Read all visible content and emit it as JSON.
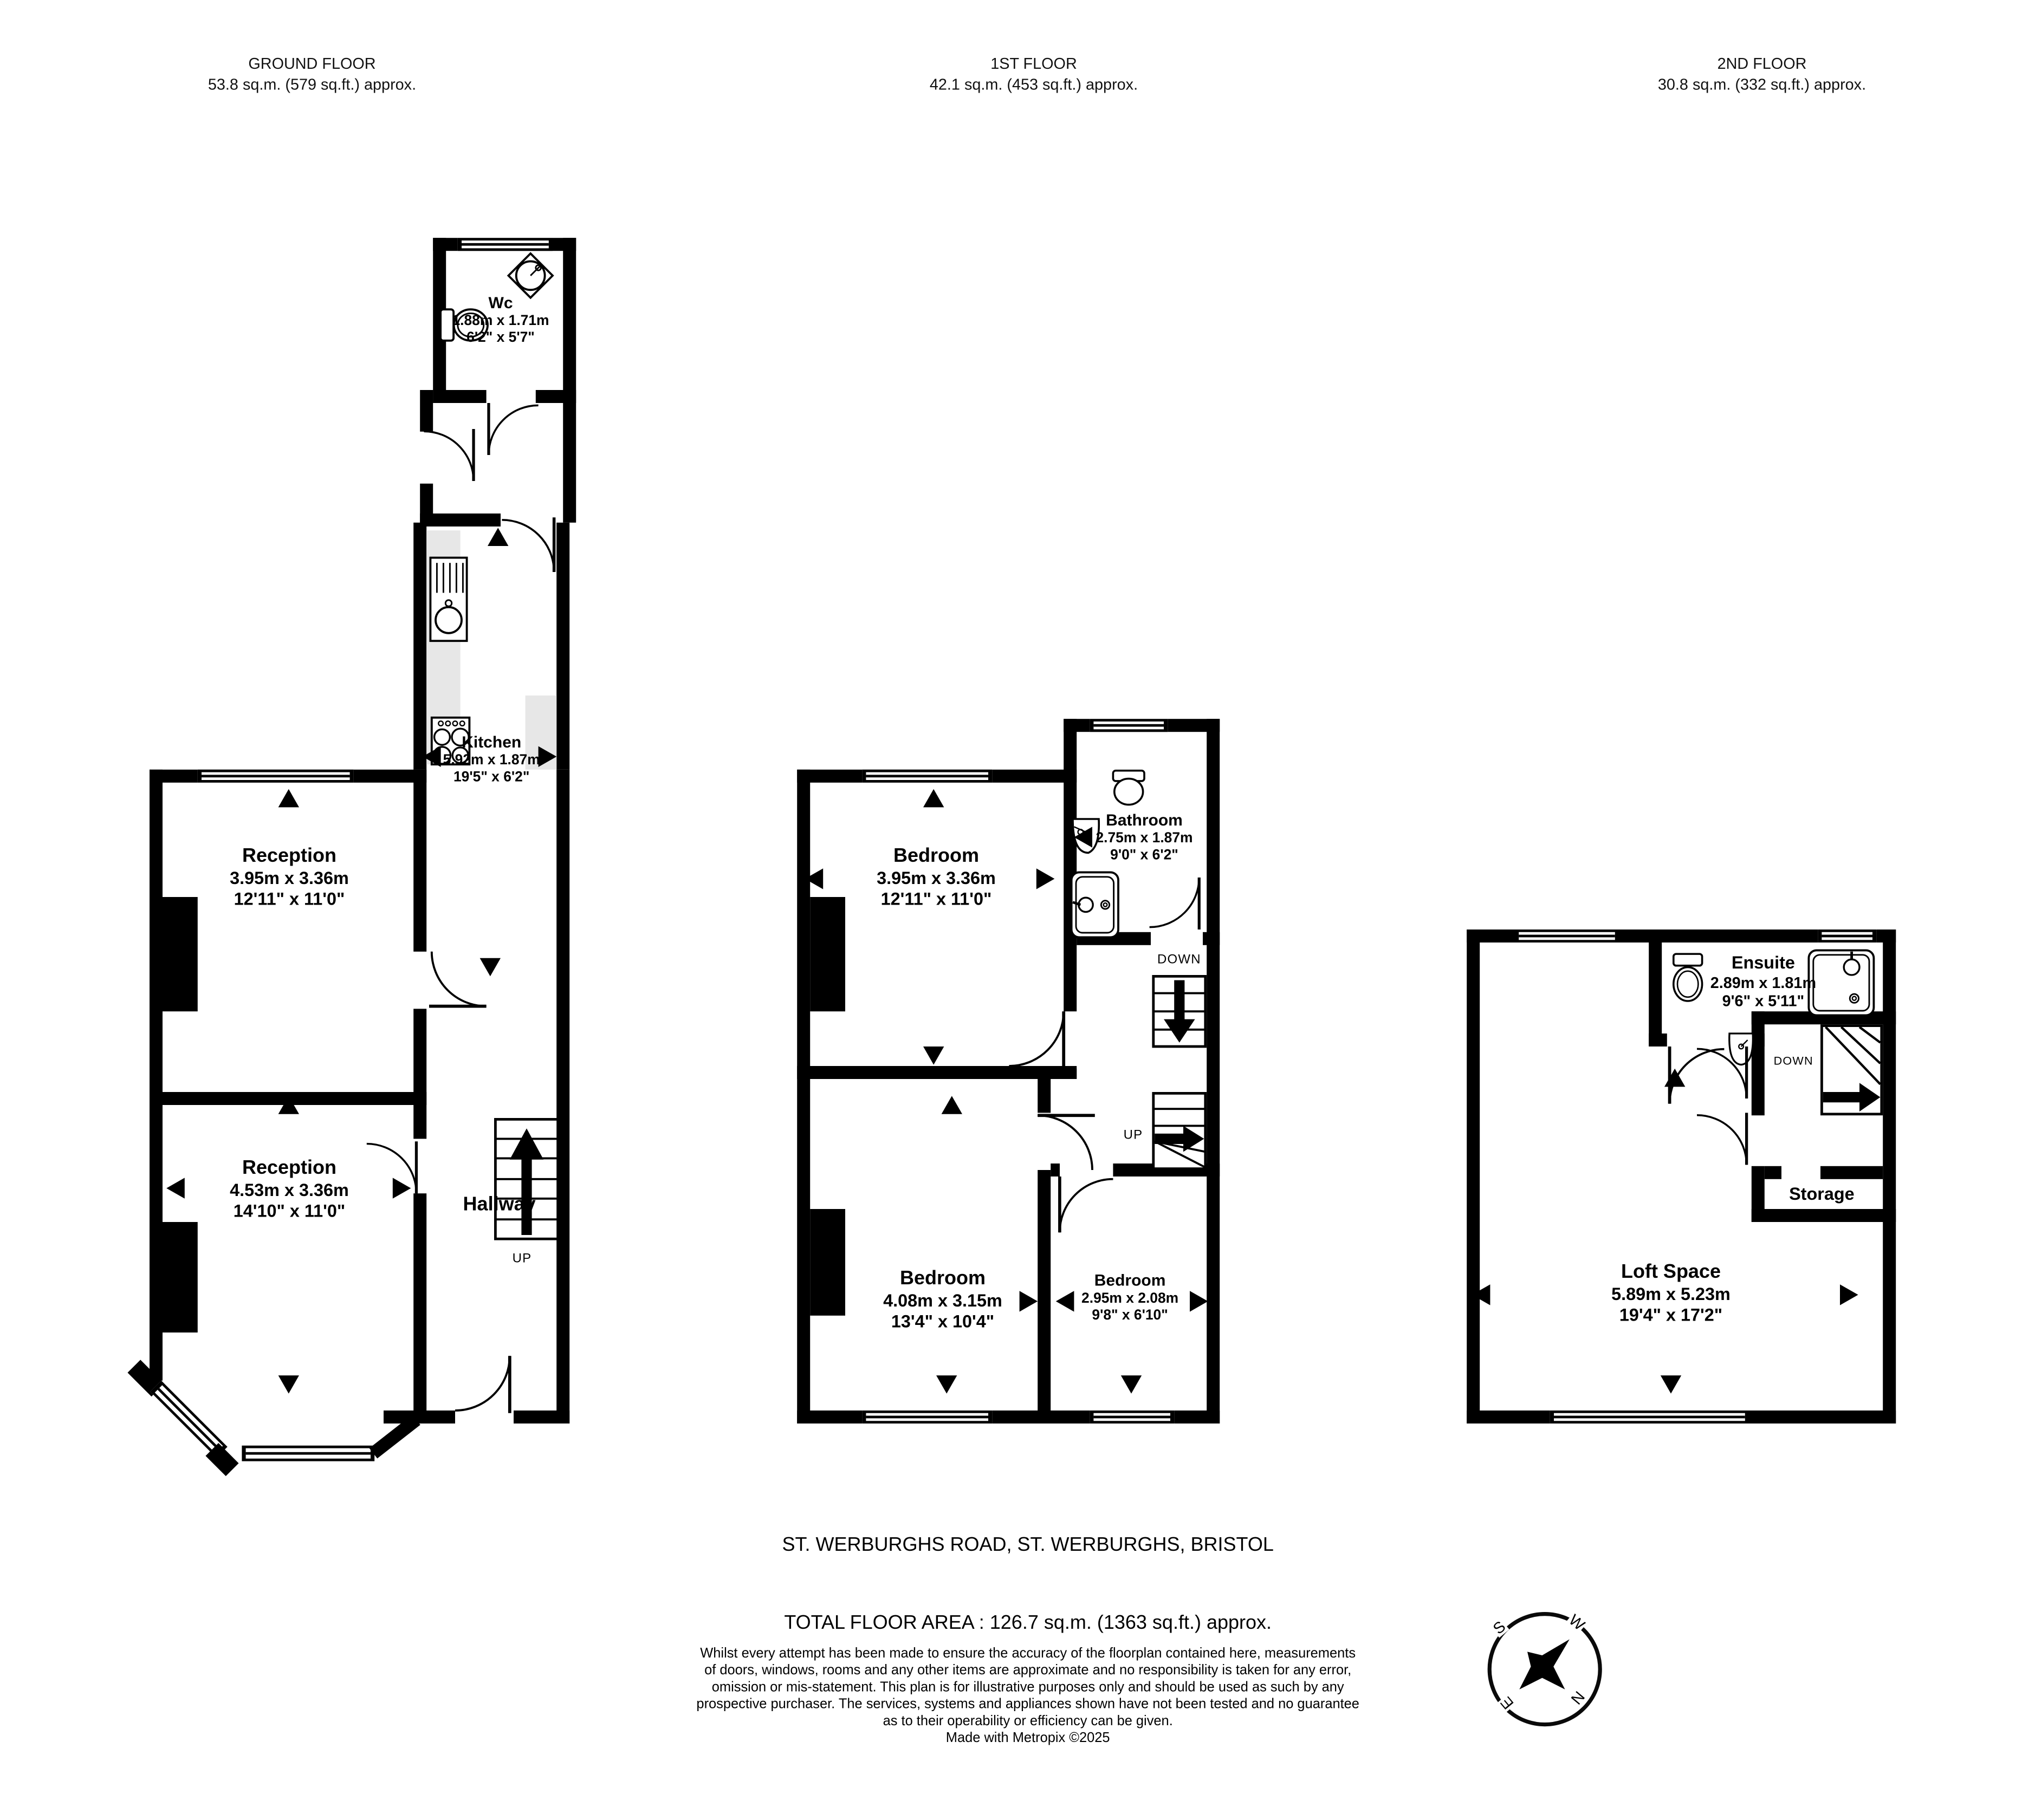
{
  "document_type": "floorplan",
  "floors": [
    {
      "id": "ground",
      "header": "GROUND FLOOR",
      "area": "53.8 sq.m. (579 sq.ft.) approx.",
      "rooms": [
        {
          "name": "Wc",
          "metric": "1.88m x 1.71m",
          "imperial": "6'2\" x 5'7\""
        },
        {
          "name": "Kitchen",
          "metric": "5.92m x 1.87m",
          "imperial": "19'5\" x 6'2\""
        },
        {
          "name": "Reception",
          "metric": "3.95m x 3.36m",
          "imperial": "12'11\" x 11'0\""
        },
        {
          "name": "Reception",
          "metric": "4.53m x 3.36m",
          "imperial": "14'10\" x 11'0\""
        },
        {
          "name": "Hallway"
        }
      ],
      "stairs_up_label": "UP"
    },
    {
      "id": "first",
      "header": "1ST FLOOR",
      "area": "42.1 sq.m. (453 sq.ft.) approx.",
      "rooms": [
        {
          "name": "Bedroom",
          "metric": "3.95m x 3.36m",
          "imperial": "12'11\" x 11'0\""
        },
        {
          "name": "Bathroom",
          "metric": "2.75m x 1.87m",
          "imperial": "9'0\" x 6'2\""
        },
        {
          "name": "Bedroom",
          "metric": "4.08m x 3.15m",
          "imperial": "13'4\" x 10'4\""
        },
        {
          "name": "Bedroom",
          "metric": "2.95m x 2.08m",
          "imperial": "9'8\" x 6'10\""
        }
      ],
      "stairs_down_label": "DOWN",
      "stairs_up_label": "UP"
    },
    {
      "id": "second",
      "header": "2ND FLOOR",
      "area": "30.8 sq.m. (332 sq.ft.) approx.",
      "rooms": [
        {
          "name": "Ensuite",
          "metric": "2.89m x 1.81m",
          "imperial": "9'6\" x 5'11\""
        },
        {
          "name": "Storage"
        },
        {
          "name": "Loft Space",
          "metric": "5.89m x 5.23m",
          "imperial": "19'4\" x 17'2\""
        }
      ],
      "stairs_down_label": "DOWN"
    }
  ],
  "footer": {
    "address": "ST. WERBURGHS ROAD, ST. WERBURGHS, BRISTOL",
    "total_area": "TOTAL FLOOR AREA : 126.7 sq.m. (1363 sq.ft.) approx.",
    "disclaimer_lines": [
      "Whilst every attempt has been made to ensure the accuracy of the floorplan contained here, measurements",
      "of doors, windows, rooms and any other items are approximate and no responsibility is taken for any error,",
      "omission or mis-statement. This plan is for illustrative purposes only and should be used as such by any",
      "prospective purchaser. The services, systems and appliances shown have not been tested and no guarantee",
      "as to their operability or efficiency can be given.",
      "Made with Metropix ©2025"
    ]
  },
  "compass": {
    "north": "N",
    "south": "S",
    "east": "E",
    "west": "W"
  },
  "colors": {
    "wall": "#000000",
    "counter": "#e7e7e7",
    "background": "#ffffff"
  }
}
